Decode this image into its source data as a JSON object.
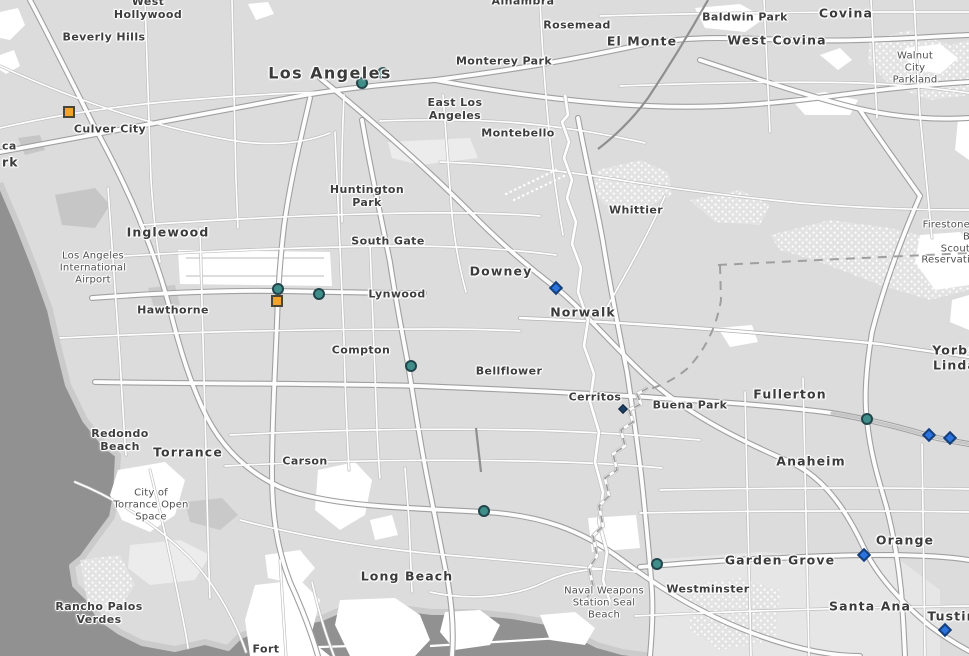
{
  "map": {
    "palette": {
      "land": "#dcdcdc",
      "ocean": "#919191",
      "ocean_wave": "#a6a6a6",
      "road_fill": "#ffffff",
      "road_casing": "#b2b2b2",
      "label_text": "#3b3b3b",
      "circle_fill": "#3F8E89",
      "circle_stroke": "#22454C",
      "square_fill": "#F0A42E",
      "square_stroke": "#4A4538",
      "diamond_fill": "#2B74E0",
      "diamond_stroke": "#163E78",
      "small_diamond_fill": "#1C3E63",
      "small_diamond_stroke": "#10263F"
    },
    "labels": [
      {
        "lines": [
          "West",
          "Hollywood"
        ],
        "x": 148,
        "y": 9,
        "cls": "town"
      },
      {
        "lines": [
          "Beverly Hills"
        ],
        "x": 104,
        "y": 38,
        "cls": "town"
      },
      {
        "lines": [
          "Culver City"
        ],
        "x": 110,
        "y": 130,
        "cls": "town"
      },
      {
        "lines": [
          "ca"
        ],
        "x": 2,
        "y": 147,
        "cls": "town",
        "anchor": "left"
      },
      {
        "lines": [
          "rk"
        ],
        "x": 2,
        "y": 163,
        "cls": "city",
        "anchor": "left"
      },
      {
        "lines": [
          "Los Angeles"
        ],
        "x": 330,
        "y": 74,
        "cls": "city-lg"
      },
      {
        "lines": [
          "Alhambra"
        ],
        "x": 523,
        "y": 2,
        "cls": "town"
      },
      {
        "lines": [
          "Rosemead"
        ],
        "x": 577,
        "y": 26,
        "cls": "town"
      },
      {
        "lines": [
          "Monterey Park"
        ],
        "x": 504,
        "y": 62,
        "cls": "town"
      },
      {
        "lines": [
          "El Monte"
        ],
        "x": 642,
        "y": 42,
        "cls": "city"
      },
      {
        "lines": [
          "Baldwin Park"
        ],
        "x": 745,
        "y": 18,
        "cls": "town"
      },
      {
        "lines": [
          "Covina"
        ],
        "x": 846,
        "y": 14,
        "cls": "city"
      },
      {
        "lines": [
          "West Covina"
        ],
        "x": 777,
        "y": 41,
        "cls": "city"
      },
      {
        "lines": [
          "Walnut City",
          "Parkland"
        ],
        "x": 915,
        "y": 68,
        "cls": "park"
      },
      {
        "lines": [
          "East Los",
          "Angeles"
        ],
        "x": 455,
        "y": 110,
        "cls": "town"
      },
      {
        "lines": [
          "Montebello"
        ],
        "x": 518,
        "y": 134,
        "cls": "town"
      },
      {
        "lines": [
          "Huntington",
          "Park"
        ],
        "x": 367,
        "y": 197,
        "cls": "town"
      },
      {
        "lines": [
          "Whittier"
        ],
        "x": 636,
        "y": 211,
        "cls": "town"
      },
      {
        "lines": [
          "South Gate"
        ],
        "x": 388,
        "y": 242,
        "cls": "town"
      },
      {
        "lines": [
          "Inglewood"
        ],
        "x": 168,
        "y": 233,
        "cls": "city"
      },
      {
        "lines": [
          "Los Angeles",
          "International",
          "Airport"
        ],
        "x": 93,
        "y": 268,
        "cls": "park"
      },
      {
        "lines": [
          "Hawthorne"
        ],
        "x": 173,
        "y": 311,
        "cls": "town"
      },
      {
        "lines": [
          "Lynwood"
        ],
        "x": 397,
        "y": 295,
        "cls": "town"
      },
      {
        "lines": [
          "Downey"
        ],
        "x": 501,
        "y": 272,
        "cls": "city"
      },
      {
        "lines": [
          "Norwalk"
        ],
        "x": 583,
        "y": 313,
        "cls": "city"
      },
      {
        "lines": [
          "Compton"
        ],
        "x": 361,
        "y": 351,
        "cls": "town"
      },
      {
        "lines": [
          "Bellflower"
        ],
        "x": 509,
        "y": 372,
        "cls": "town"
      },
      {
        "lines": [
          "Cerritos"
        ],
        "x": 595,
        "y": 398,
        "cls": "town"
      },
      {
        "lines": [
          "Buena Park"
        ],
        "x": 690,
        "y": 406,
        "cls": "town"
      },
      {
        "lines": [
          "Fullerton"
        ],
        "x": 790,
        "y": 395,
        "cls": "city"
      },
      {
        "lines": [
          "Anaheim"
        ],
        "x": 811,
        "y": 462,
        "cls": "city"
      },
      {
        "lines": [
          "Yorba Linda"
        ],
        "x": 955,
        "y": 358,
        "cls": "city"
      },
      {
        "lines": [
          "Firestone B",
          "Scout",
          "Reservati"
        ],
        "x": 970,
        "y": 243,
        "cls": "park",
        "anchor": "right"
      },
      {
        "lines": [
          "Redondo",
          "Beach"
        ],
        "x": 120,
        "y": 441,
        "cls": "town"
      },
      {
        "lines": [
          "Torrance"
        ],
        "x": 188,
        "y": 453,
        "cls": "city"
      },
      {
        "lines": [
          "Carson"
        ],
        "x": 305,
        "y": 462,
        "cls": "town"
      },
      {
        "lines": [
          "City of",
          "Torrance Open",
          "Space"
        ],
        "x": 151,
        "y": 505,
        "cls": "park"
      },
      {
        "lines": [
          "Rancho Palos",
          "Verdes"
        ],
        "x": 99,
        "y": 614,
        "cls": "town"
      },
      {
        "lines": [
          "Fort"
        ],
        "x": 266,
        "y": 650,
        "cls": "town"
      },
      {
        "lines": [
          "Long Beach"
        ],
        "x": 407,
        "y": 577,
        "cls": "city"
      },
      {
        "lines": [
          "Naval Weapons",
          "Station Seal",
          "Beach"
        ],
        "x": 604,
        "y": 603,
        "cls": "park"
      },
      {
        "lines": [
          "Westminster"
        ],
        "x": 708,
        "y": 590,
        "cls": "town"
      },
      {
        "lines": [
          "Garden Grove"
        ],
        "x": 780,
        "y": 561,
        "cls": "city"
      },
      {
        "lines": [
          "Orange"
        ],
        "x": 905,
        "y": 541,
        "cls": "city"
      },
      {
        "lines": [
          "Santa Ana"
        ],
        "x": 870,
        "y": 607,
        "cls": "city"
      },
      {
        "lines": [
          "Tustin"
        ],
        "x": 952,
        "y": 617,
        "cls": "city"
      }
    ],
    "markers": {
      "circles": [
        [
          362,
          83
        ],
        [
          383,
          73
        ],
        [
          278,
          289
        ],
        [
          319,
          294
        ],
        [
          411,
          366
        ],
        [
          484,
          511
        ],
        [
          657,
          564
        ],
        [
          867,
          419
        ]
      ],
      "squares": [
        [
          69,
          112
        ],
        [
          277,
          301
        ]
      ],
      "diamonds": [
        [
          556,
          288
        ],
        [
          929,
          435
        ],
        [
          950,
          438
        ],
        [
          864,
          555
        ],
        [
          945,
          630
        ]
      ],
      "small_diamonds": [
        [
          623,
          409
        ]
      ]
    }
  }
}
